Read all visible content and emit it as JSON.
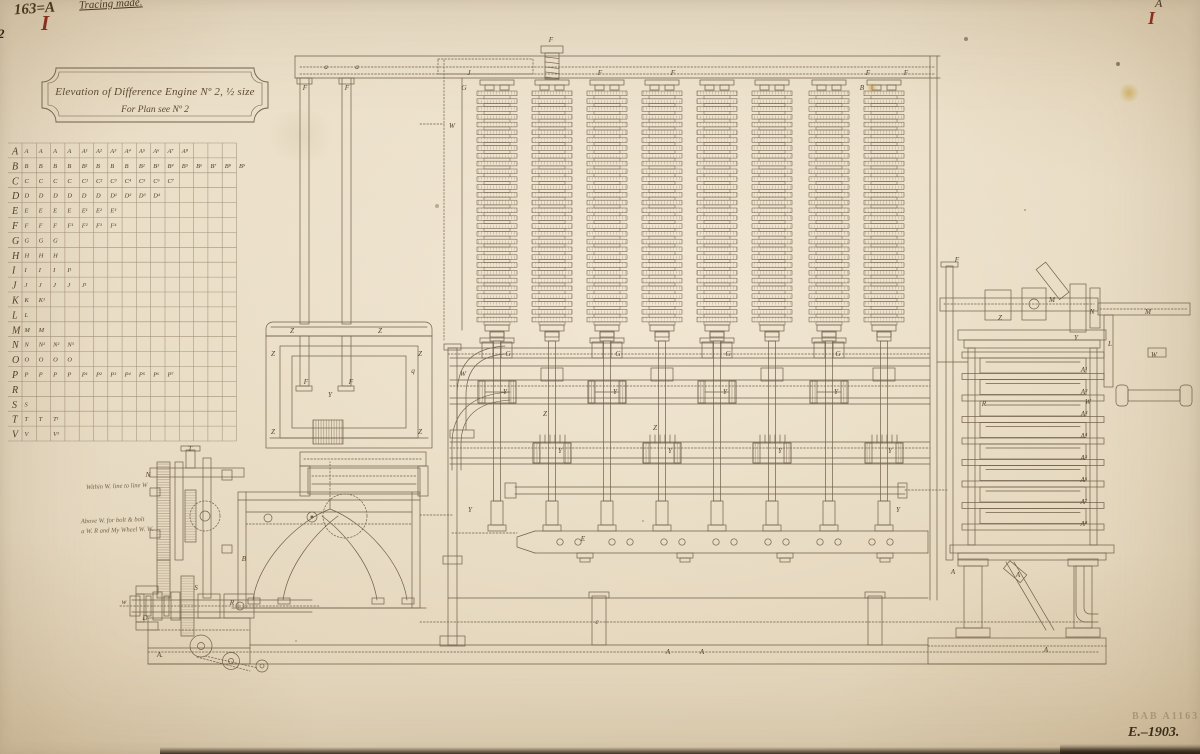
{
  "annotations": {
    "top_left_number": "163=A",
    "tracing_note": "Tracing made.",
    "red_numeral_left": "I",
    "top_right_letter": "A",
    "red_numeral_right": "I",
    "edge_mark": "2",
    "left_note_1": "Within W. line to line W",
    "left_note_2": "Above W. for bolt & bolt",
    "left_note_3": "a W. R and My Wheel W. W.",
    "stamp": "BAB A1163",
    "catalog_number": "E.–1903."
  },
  "cartouche": {
    "line1": "Elevation of Difference Engine Nº 2, ½ size",
    "line2": "For Plan see Nº 2"
  },
  "parts_table": {
    "columns": 15,
    "rows": [
      {
        "label": "A",
        "cells": [
          "A",
          "A",
          "A",
          "A",
          "A¹",
          "A²",
          "A³",
          "A⁴",
          "A⁵",
          "A⁶",
          "A⁷",
          "A⁸"
        ]
      },
      {
        "label": "B",
        "cells": [
          "B",
          "B",
          "B",
          "B",
          "B¹",
          "B",
          "B",
          "B",
          "B²",
          "B³",
          "B⁴",
          "B⁵",
          "B⁶",
          "B⁷",
          "B⁸",
          "B⁹"
        ]
      },
      {
        "label": "C",
        "cells": [
          "C",
          "C",
          "C",
          "C",
          "C¹",
          "C²",
          "C³",
          "C⁴",
          "C⁵",
          "C⁶",
          "C⁷"
        ]
      },
      {
        "label": "D",
        "cells": [
          "D",
          "D",
          "D",
          "D",
          "D",
          "D",
          "D¹",
          "D²",
          "D³",
          "D⁴"
        ]
      },
      {
        "label": "E",
        "cells": [
          "E",
          "E",
          "E",
          "E",
          "E¹",
          "E²",
          "E³"
        ]
      },
      {
        "label": "F",
        "cells": [
          "F",
          "F",
          "F",
          "F¹",
          "F²",
          "F³",
          "F⁴"
        ]
      },
      {
        "label": "G",
        "cells": [
          "G",
          "G",
          "G"
        ]
      },
      {
        "label": "H",
        "cells": [
          "H",
          "H",
          "H"
        ]
      },
      {
        "label": "I",
        "cells": [
          "I",
          "I",
          "I",
          "I¹"
        ]
      },
      {
        "label": "J",
        "cells": [
          "J",
          "J",
          "J",
          "J",
          "J¹"
        ]
      },
      {
        "label": "K",
        "cells": [
          "K",
          "K¹"
        ]
      },
      {
        "label": "L",
        "cells": [
          "L"
        ]
      },
      {
        "label": "M",
        "cells": [
          "M",
          "M"
        ]
      },
      {
        "label": "N",
        "cells": [
          "N",
          "N¹",
          "N²",
          "N³"
        ]
      },
      {
        "label": "O",
        "cells": [
          "O",
          "O",
          "O",
          "O"
        ]
      },
      {
        "label": "P",
        "cells": [
          "P",
          "P",
          "P",
          "P",
          "P¹",
          "P²",
          "P³",
          "P⁴",
          "P⁵",
          "P⁶",
          "P⁷"
        ]
      },
      {
        "label": "R",
        "cells": []
      },
      {
        "label": "S",
        "cells": [
          "S"
        ]
      },
      {
        "label": "T",
        "cells": [
          "T",
          "T",
          "T¹"
        ]
      },
      {
        "label": "V",
        "cells": [
          "V",
          "",
          "V¹"
        ]
      }
    ]
  },
  "machine": {
    "wheel_columns": 8,
    "wheels_per_column": 30,
    "column_xs": [
      497,
      552,
      607,
      662,
      717,
      772,
      829,
      884
    ],
    "labels": [
      [
        326,
        69,
        "a"
      ],
      [
        357,
        69,
        "a"
      ],
      [
        551,
        42,
        "F"
      ],
      [
        469,
        75,
        "J"
      ],
      [
        600,
        75,
        "F"
      ],
      [
        673,
        75,
        "F"
      ],
      [
        868,
        75,
        "F"
      ],
      [
        906,
        75,
        "F"
      ],
      [
        305,
        90,
        "F"
      ],
      [
        347,
        90,
        "F"
      ],
      [
        464,
        90,
        "G"
      ],
      [
        862,
        90,
        "B"
      ],
      [
        452,
        128,
        "W"
      ],
      [
        292,
        333,
        "Z"
      ],
      [
        380,
        333,
        "Z"
      ],
      [
        273,
        356,
        "Z"
      ],
      [
        420,
        356,
        "Z"
      ],
      [
        306,
        384,
        "F"
      ],
      [
        351,
        384,
        "F"
      ],
      [
        330,
        397,
        "Y"
      ],
      [
        273,
        434,
        "Z"
      ],
      [
        420,
        434,
        "Z"
      ],
      [
        413,
        373,
        "q"
      ],
      [
        463,
        376,
        "W"
      ],
      [
        505,
        394,
        "Y"
      ],
      [
        615,
        394,
        "Y"
      ],
      [
        725,
        394,
        "Y"
      ],
      [
        836,
        394,
        "Y"
      ],
      [
        560,
        453,
        "Y"
      ],
      [
        670,
        453,
        "Y"
      ],
      [
        780,
        453,
        "Y"
      ],
      [
        890,
        453,
        "Y"
      ],
      [
        508,
        356,
        "G"
      ],
      [
        618,
        356,
        "G"
      ],
      [
        728,
        356,
        "G"
      ],
      [
        838,
        356,
        "G"
      ],
      [
        545,
        416,
        "Z"
      ],
      [
        655,
        430,
        "Z"
      ],
      [
        583,
        541,
        "E"
      ],
      [
        597,
        624,
        "c"
      ],
      [
        470,
        512,
        "Y"
      ],
      [
        898,
        512,
        "Y"
      ],
      [
        160,
        657,
        "A."
      ],
      [
        668,
        654,
        "A"
      ],
      [
        702,
        654,
        "A"
      ],
      [
        1046,
        652,
        "A"
      ],
      [
        190,
        451,
        "T"
      ],
      [
        148,
        477,
        "N"
      ],
      [
        244,
        561,
        "B"
      ],
      [
        145,
        620,
        "D"
      ],
      [
        232,
        605,
        "R"
      ],
      [
        124,
        604,
        "w"
      ],
      [
        196,
        590,
        "S"
      ],
      [
        957,
        262,
        "F"
      ],
      [
        1000,
        320,
        "Z"
      ],
      [
        1052,
        302,
        "M"
      ],
      [
        1092,
        314,
        "N"
      ],
      [
        1076,
        340,
        "Y"
      ],
      [
        984,
        406,
        "R"
      ],
      [
        1088,
        404,
        "W"
      ],
      [
        1148,
        314,
        "M"
      ],
      [
        1154,
        357,
        "W"
      ],
      [
        1110,
        346,
        "L"
      ],
      [
        1018,
        577,
        "A"
      ],
      [
        953,
        574,
        "A"
      ],
      [
        1084,
        372,
        "A¹"
      ],
      [
        1084,
        394,
        "A²"
      ],
      [
        1084,
        416,
        "A³"
      ],
      [
        1084,
        438,
        "A⁴"
      ],
      [
        1084,
        460,
        "A⁵"
      ],
      [
        1084,
        482,
        "A⁶"
      ],
      [
        1084,
        504,
        "A⁷"
      ],
      [
        1084,
        526,
        "A⁸"
      ]
    ]
  },
  "colors": {
    "paper": "#e8dbc4",
    "ink": "#6f604b",
    "grid": "#a3927a",
    "label": "#55432e",
    "handwriting": "#44331f",
    "red": "#8a2b1c"
  }
}
